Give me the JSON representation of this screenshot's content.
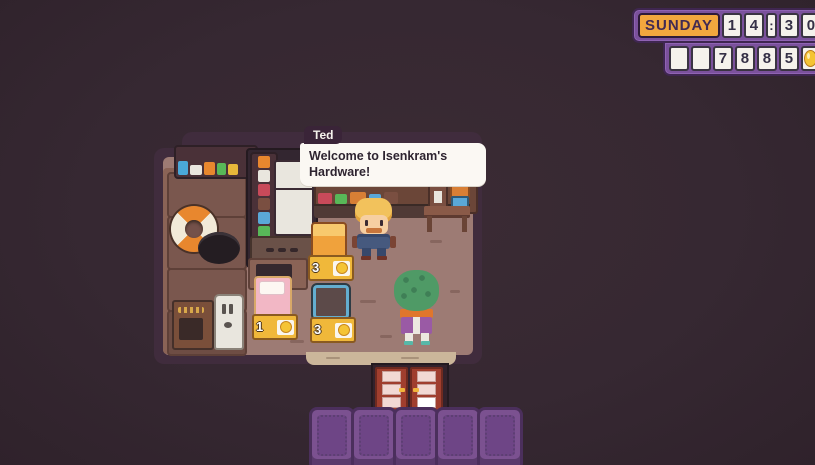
{
  "hud": {
    "day": "SUNDAY",
    "time": [
      "1",
      "4",
      ":",
      "3",
      "0"
    ],
    "time_value": "14:30",
    "money": [
      "",
      "",
      "7",
      "8",
      "8",
      "5"
    ],
    "money_value": "7885",
    "currency_icon": "coin-icon"
  },
  "dialogue": {
    "speaker": "Ted",
    "lines": [
      "Welcome to Isenkram's",
      "Hardware!"
    ]
  },
  "shop_items": [
    {
      "name": "orange furnace",
      "price": "3"
    },
    {
      "name": "pink bed",
      "price": "1"
    },
    {
      "name": "blue screen",
      "price": "3"
    }
  ],
  "scene": {
    "location": "Isenkram's Hardware shop interior",
    "npc": "Ted the shopkeeper",
    "player": "green-haired player character facing the counter"
  },
  "colors": {
    "background": "#362832",
    "hud_panel": "#7b519c",
    "hud_day_bg": "#f2a73e",
    "coin": "#f5c435",
    "bubble_bg": "#fbf8f3",
    "room_border": "#402c3d",
    "floor": "#9d7b74",
    "tile": "#7b5190",
    "door": "#a03e2e"
  }
}
